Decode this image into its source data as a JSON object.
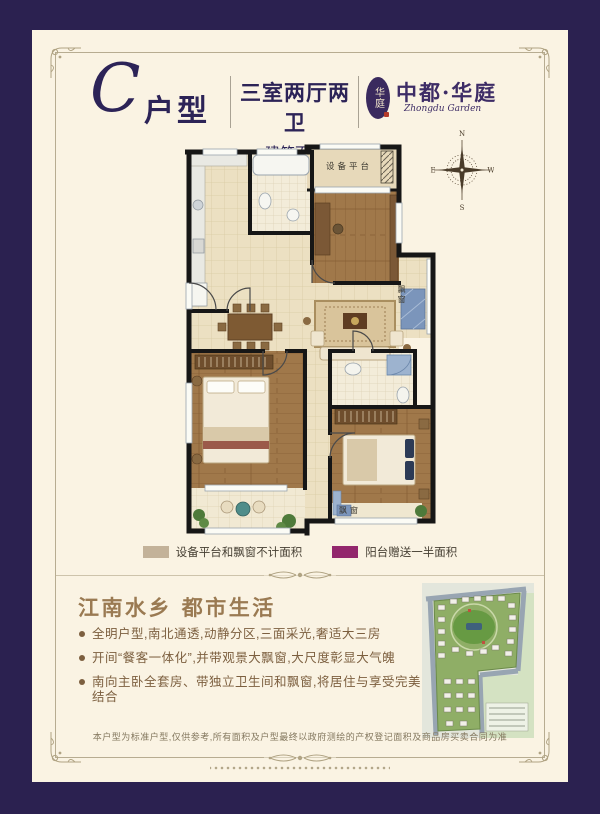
{
  "colors": {
    "border_navy": "#2b2150",
    "card_cream": "#faf3e3",
    "heading_navy": "#2c2357",
    "brand_purple": "#3d2c66",
    "title_bronze": "#9a7a52",
    "body_brown": "#7c5f3f",
    "legend_tan": "#c3b299",
    "legend_magenta": "#93276d"
  },
  "header": {
    "unit_letter": "C",
    "unit_suffix": "户型",
    "spec": "三室两厅两卫",
    "area": "建筑面积约:108m²",
    "brand": {
      "seal": "华庭",
      "name_cn": "中都·华庭",
      "name_en": "Zhongdu Garden"
    }
  },
  "compass": {
    "north": "N",
    "south": "S",
    "east": "E",
    "west": "W"
  },
  "floor_plan": {
    "labels": {
      "equipment_platform": "设备平台",
      "bay_window_side": "飘窗",
      "bay_window_bottom": "飘窗"
    }
  },
  "legend": {
    "items": [
      {
        "label": "设备平台和飘窗不计面积",
        "color": "#c3b299"
      },
      {
        "label": "阳台赠送一半面积",
        "color": "#93276d"
      }
    ]
  },
  "section": {
    "title": "江南水乡  都市生活",
    "bullets": [
      "全明户型,南北通透,动静分区,三面采光,奢适大三房",
      "开间“餐客一体化”,并带观景大飘窗,大尺度彰显大气魄",
      "南向主卧全套房、带独立卫生间和飘窗,将居住与享受完美结合"
    ]
  },
  "footer": {
    "disclaimer": "本户型为标准户型,仅供参考,所有面积及户型最终以政府测绘的产权登记面积及商品房买卖合同为准"
  }
}
